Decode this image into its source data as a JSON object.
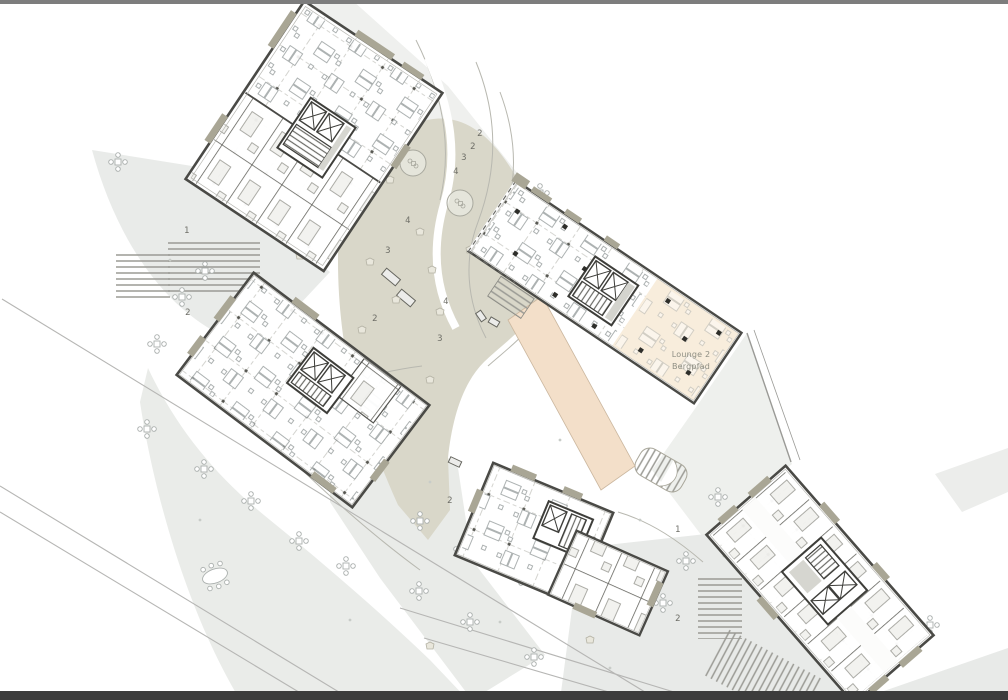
{
  "plan": {
    "lounge_label": {
      "line1": "Lounge 2",
      "line2": "Bergpfad"
    },
    "zone_markers": [
      {
        "label": "1",
        "x": 187,
        "y": 231
      },
      {
        "label": "2",
        "x": 188,
        "y": 313
      },
      {
        "label": "2",
        "x": 480,
        "y": 134
      },
      {
        "label": "2",
        "x": 473,
        "y": 147
      },
      {
        "label": "3",
        "x": 464,
        "y": 158
      },
      {
        "label": "4",
        "x": 456,
        "y": 172
      },
      {
        "label": "4",
        "x": 408,
        "y": 221
      },
      {
        "label": "3",
        "x": 388,
        "y": 251
      },
      {
        "label": "4",
        "x": 446,
        "y": 302
      },
      {
        "label": "2",
        "x": 375,
        "y": 319
      },
      {
        "label": "3",
        "x": 440,
        "y": 339
      },
      {
        "label": "2",
        "x": 450,
        "y": 501
      },
      {
        "label": "1",
        "x": 678,
        "y": 530
      },
      {
        "label": "2",
        "x": 678,
        "y": 619
      }
    ],
    "colors": {
      "wall": "#4a4a46",
      "plaza": "#d9d7c9",
      "path_gray": "#e9ebe9",
      "lounge_fill": "#f8eddc",
      "walkway_peach": "#f3dfc9",
      "facade_accent": "#a9a695",
      "frame_top": "#7d7d7d",
      "frame_bottom": "#3c3c3c"
    }
  }
}
